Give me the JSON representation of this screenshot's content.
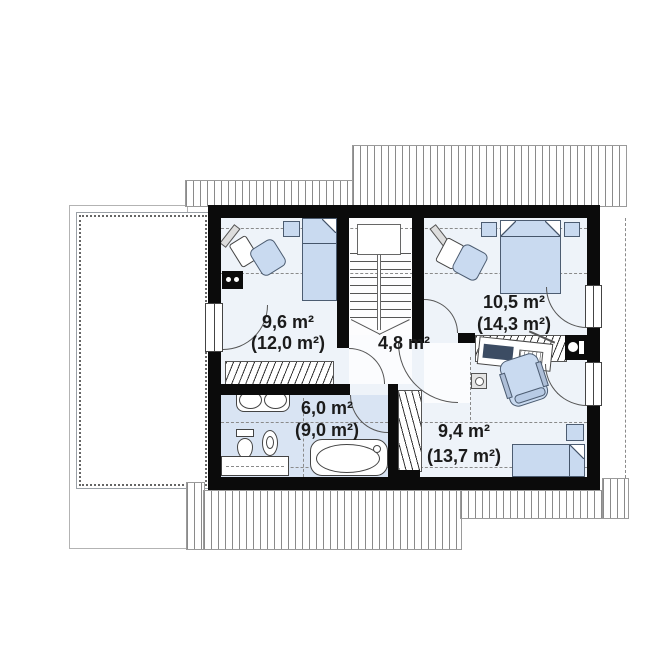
{
  "plan": {
    "title": "attic-floor-plan",
    "rooms": {
      "bedroom_left": {
        "area": "9,6 m²",
        "floor_area_total": "(12,0 m²)"
      },
      "bedroom_top_right": {
        "area": "10,5 m²",
        "floor_area_total": "(14,3 m²)"
      },
      "hallway": {
        "area": "4,8 m²"
      },
      "bathroom": {
        "area": "6,0 m²",
        "floor_area_total": "(9,0 m²)"
      },
      "bedroom_bottom_right": {
        "area": "9,4 m²",
        "floor_area_total": "(13,7 m²)"
      }
    },
    "colors": {
      "wall": "#0b0b0b",
      "room_floor": "#eef3f9",
      "bathroom_floor": "#d9e4f3",
      "furniture": "#c9daf0"
    }
  }
}
